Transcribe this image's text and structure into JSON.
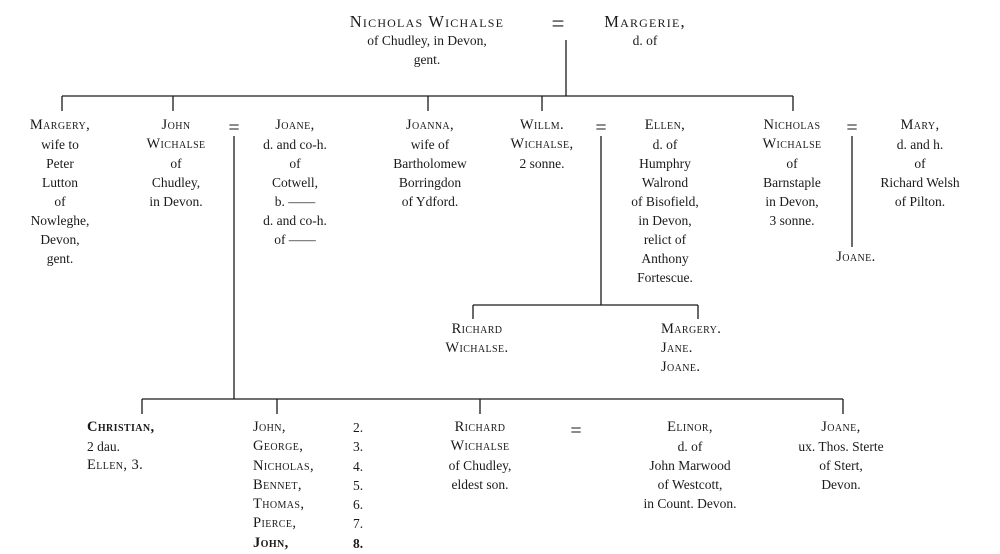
{
  "eq": "=",
  "generation1": {
    "husband": {
      "name": "Nicholas Wichalse",
      "desc": "of Chudley, in Devon,\ngent."
    },
    "wife": {
      "name": "Margerie,",
      "desc": "d. of"
    }
  },
  "generation2": {
    "margery": {
      "name": "Margery,",
      "desc": "wife to\nPeter\nLutton\nof\nNowleghe,\nDevon,\ngent."
    },
    "john": {
      "name": "John\nWichalse",
      "desc": "of\nChudley,\nin Devon."
    },
    "joane": {
      "name": "Joane,",
      "desc": "d. and co-h.\nof\nCotwell,\nb. ——\nd. and co-h.\nof ——"
    },
    "joanna": {
      "name": "Joanna,",
      "desc": "wife of\nBartholomew\nBorringdon\nof Ydford."
    },
    "willm": {
      "name": "Willm.\nWichalse,",
      "desc": "2 sonne."
    },
    "ellen": {
      "name": "Ellen,",
      "desc": "d. of\nHumphry\nWalrond\nof Bisofield,\nin Devon,\nrelict of\nAnthony\nFortescue."
    },
    "nicholas": {
      "name": "Nicholas\nWichalse",
      "desc": "of\nBarnstaple\nin Devon,\n3 sonne."
    },
    "mary": {
      "name": "Mary,",
      "desc": "d. and h.\nof\nRichard Welsh\nof Pilton."
    },
    "joane_daughter": {
      "name": "Joane."
    }
  },
  "generation3": {
    "richard": {
      "name": "Richard\nWichalse."
    },
    "daughters": {
      "name": "Margery.\nJane.\nJoane."
    }
  },
  "generation4": {
    "christian": {
      "lines": [
        "Christian,",
        "2 dau.",
        "Ellen, 3."
      ]
    },
    "siblings": [
      {
        "name": "John,",
        "num": "2."
      },
      {
        "name": "George,",
        "num": "3."
      },
      {
        "name": "Nicholas,",
        "num": "4."
      },
      {
        "name": "Bennet,",
        "num": "5."
      },
      {
        "name": "Thomas,",
        "num": "6."
      },
      {
        "name": "Pierce,",
        "num": "7."
      },
      {
        "name": "John,",
        "num": "8."
      }
    ],
    "richard": {
      "name": "Richard\nWichalse",
      "desc": "of Chudley,\neldest son."
    },
    "elinor": {
      "name": "Elinor,",
      "desc": "d. of\nJohn Marwood\nof Westcott,\nin Count. Devon."
    },
    "joane": {
      "name": "Joane,",
      "desc": "ux. Thos. Sterte\nof Stert,\nDevon."
    }
  },
  "colors": {
    "ink": "#1a1a1a",
    "background": "#ffffff"
  }
}
